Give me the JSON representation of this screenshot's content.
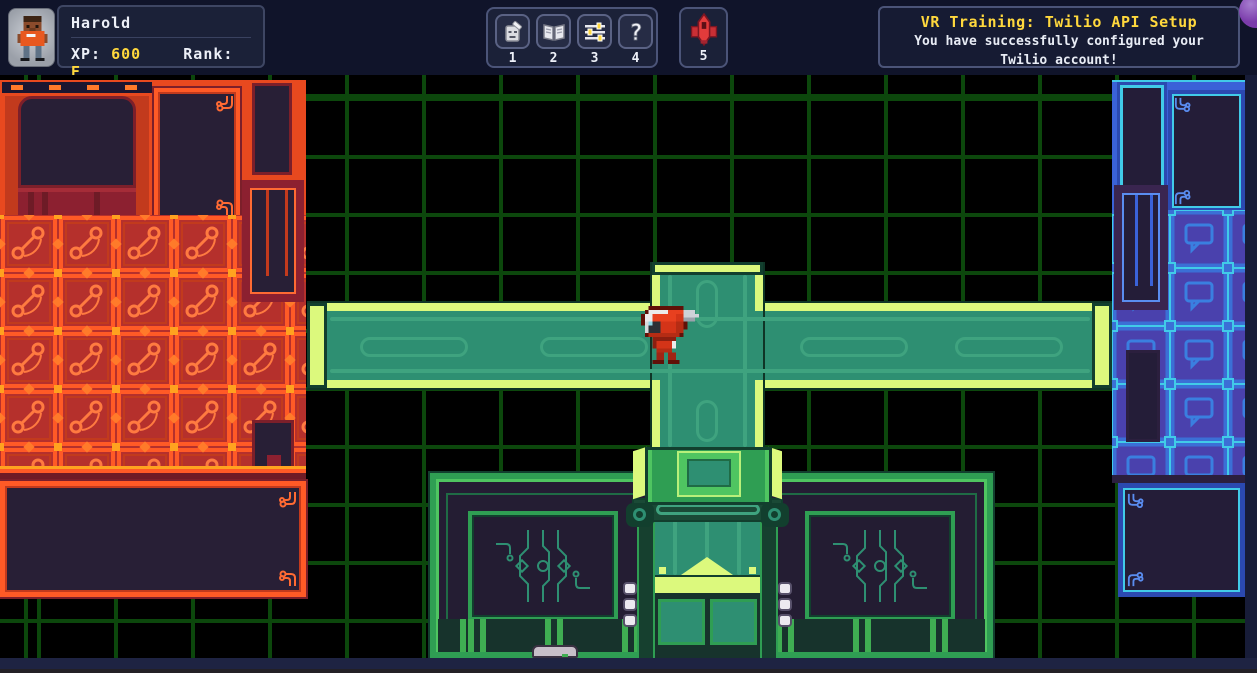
{
  "palette": {
    "accent_yellow": "#ffd83d",
    "grid_green": "#0c470c",
    "orange_base": "#e8491f",
    "orange_tile": "#b5302c",
    "blue_frame": "#3a62d8",
    "blue_tile": "#4a41ad",
    "cyan": "#41cbe8",
    "teal_deck": "#2e8f72",
    "lime": "#dcf97d",
    "green_bright": "#4fc561",
    "ship_red": "#d93a3a",
    "purple_btn": "#7b3cab"
  },
  "hud": {
    "player": {
      "name": "Harold",
      "xp_label": "XP:",
      "xp_value": "600",
      "rank_label": "Rank:",
      "rank_value": "E"
    },
    "hotbar": {
      "slots": [
        {
          "number": "1",
          "icon": "stone-idol"
        },
        {
          "number": "2",
          "icon": "journal-book"
        },
        {
          "number": "3",
          "icon": "settings-sliders"
        },
        {
          "number": "4",
          "icon": "help-question"
        }
      ],
      "ship_slot": {
        "number": "5",
        "icon": "red-ship"
      }
    },
    "notification": {
      "title": "VR Training: Twilio API Setup",
      "body": "You have successfully configured your Twilio account!"
    }
  },
  "scene": {
    "player_character": "red-robot-avatar",
    "areas": {
      "left": "orange-phone-wing",
      "right": "blue-chat-wing",
      "bottom": "green-terminal-building",
      "center": "green-cross-walkway"
    }
  }
}
